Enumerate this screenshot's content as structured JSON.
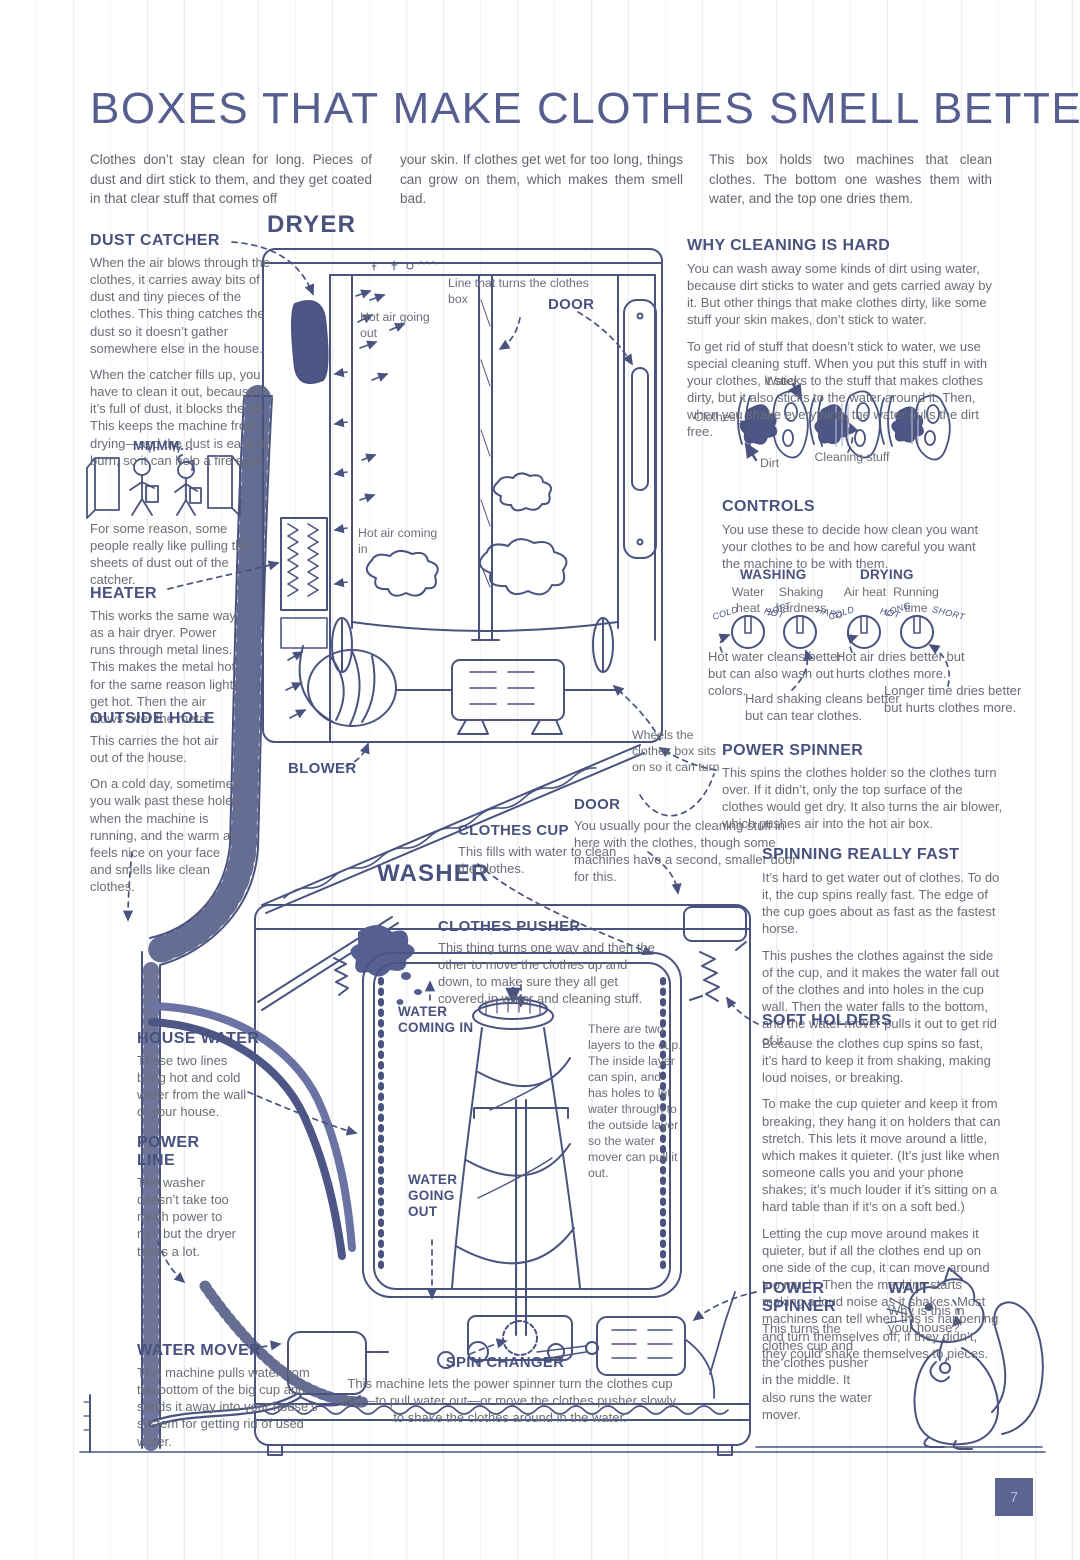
{
  "page": {
    "title": "BOXES THAT MAKE CLOTHES SMELL BETTER",
    "page_number": "7"
  },
  "intro": {
    "col1": "Clothes don’t stay clean for long. Pieces of dust and dirt stick to them, and they get coated in that clear stuff that comes off",
    "col2": "your skin. If clothes get wet for too long, things can grow on them, which makes them smell bad.",
    "col3": "This box holds two machines that clean clothes. The bottom one washes them with water, and the top one dries them."
  },
  "left": {
    "dust_catcher": {
      "title": "DUST CATCHER",
      "p1": "When the air blows through the clothes, it carries away bits of dust and tiny pieces of the clothes. This thing catches the dust so it doesn’t gather somewhere else in the house.",
      "p2": "When the catcher fills up, you have to clean it out, because if it’s full of dust, it blocks the air. This keeps the machine from drying—and the dust is easy to burn, so it can help a fire start.",
      "comic_speech": "MMMM...",
      "comic_caption": "For some reason, some people really like pulling the sheets of dust out of the catcher."
    },
    "heater": {
      "title": "HEATER",
      "p1": "This works the same way as a hair dryer. Power runs through metal lines. This makes the metal hot for the same reason lights get hot. Then the air blows over the metal."
    },
    "outside_hole": {
      "title": "OUTSIDE HOLE",
      "p1": "This carries the hot air out of the house.",
      "p2": "On a cold day, sometimes you walk past these holes when the machine is running, and the warm air feels nice on your face and smells like clean clothes."
    },
    "house_water": {
      "title": "HOUSE WATER",
      "p1": "These two lines bring hot and cold water from the wall of your house."
    },
    "power_line": {
      "title": "POWER LINE",
      "p1": "The washer doesn’t take too much power to run, but the dryer takes a lot."
    },
    "water_mover": {
      "title": "WATER MOVER",
      "p1": "This machine pulls water from the bottom of the big cup and sends it away into your house’s system for getting rid of used water."
    }
  },
  "diagram": {
    "dryer_label": "DRYER",
    "washer_label": "WASHER",
    "line_turns": "Line that turns the clothes box",
    "door_dryer": "DOOR",
    "hot_air_out": "Hot air going out",
    "hot_air_in": "Hot air coming in",
    "blower": "BLOWER",
    "wheels": "Wheels the clothes box sits on so it can turn",
    "door_washer": {
      "title": "DOOR",
      "p1": "You usually pour the cleaning stuff in here with the clothes, though some machines have a second, smaller door for this."
    },
    "clothes_cup": {
      "title": "CLOTHES CUP",
      "p1": "This fills with water to clean the clothes."
    },
    "clothes_pusher": {
      "title": "CLOTHES PUSHER",
      "p1": "This thing turns one way and then the other to move the clothes up and down, to make sure they all get covered in water and cleaning stuff."
    },
    "water_in": "WATER COMING IN",
    "water_out": "WATER GOING OUT",
    "two_layers": "There are two layers to the cup. The inside layer can spin, and has holes to let water through to the outside layer so the water mover can pull it out.",
    "spin_changer": {
      "title": "SPIN CHANGER",
      "p1": "This machine lets the power spinner turn the clothes cup fast—to pull water out—or move the clothes pusher slowly, to shake the clothes around in the water."
    }
  },
  "right": {
    "why_cleaning": {
      "title": "WHY CLEANING IS HARD",
      "p1": "You can wash away some kinds of dirt using water, because dirt sticks to water and gets carried away by it. But other things that make clothes dirty, like some stuff your skin makes, don’t stick to water.",
      "p2": "To get rid of stuff that doesn’t stick to water, we use special cleaning stuff. When you put this stuff in with your clothes, it sticks to the stuff that makes clothes dirty, but it also sticks to the water around it. Then, when you shake everything, the water pulls the dirt free.",
      "labels": {
        "water": "Water",
        "clothes": "Clothes",
        "dirt": "Dirt",
        "cleaning": "Cleaning stuff"
      }
    },
    "controls": {
      "title": "CONTROLS",
      "p1": "You use these to decide how clean you want your clothes to be and how careful you want the machine to be with them.",
      "washing": "WASHING",
      "drying": "DRYING",
      "knob1": "Water heat",
      "knob2": "Shaking hardness",
      "knob3": "Air heat",
      "knob4": "Running time",
      "dials": [
        [
          "COLD",
          "HOT"
        ],
        [
          "SOFT",
          "HARD"
        ],
        [
          "COLD",
          "HOT"
        ],
        [
          "LONG",
          "SHORT"
        ]
      ],
      "c1": "Hot water cleans better but can also wash out colors.",
      "c2": "Hard shaking cleans better but can tear clothes.",
      "c3": "Hot air dries better but hurts clothes more.",
      "c4": "Longer time dries better but hurts clothes more."
    },
    "power_spinner_top": {
      "title": "POWER SPINNER",
      "p1": "This spins the clothes holder so the clothes turn over. If it didn’t, only the top surface of the clothes would get dry. It also turns the air blower, which pushes air into the hot air box."
    },
    "spinning_fast": {
      "title": "SPINNING REALLY FAST",
      "p1": "It’s hard to get water out of clothes. To do it, the cup spins really fast. The edge of the cup goes about as fast as the fastest horse.",
      "p2": "This pushes the clothes against the side of the cup, and it makes the water fall out of the clothes and into holes in the cup wall. Then the water falls to the bottom, and the water mover pulls it out to get rid of it."
    },
    "soft_holders": {
      "title": "SOFT HOLDERS",
      "p1": "Because the clothes cup spins so fast, it’s hard to keep it from shaking, making loud noises, or breaking.",
      "p2": "To make the cup quieter and keep it from breaking, they hang it on holders that can stretch. This lets it move around a little, which makes it quieter. (It’s just like when someone calls you and your phone shakes; it’s much louder if it’s sitting on a hard table than if it’s on a soft bed.)",
      "p3": "Letting the cup move around makes it quieter, but if all the clothes end up on one side of the cup, it can move around too much. Then the machine starts making a loud noise as it shakes. Most machines can tell when this is happening and turn themselves off; if they didn’t, they could shake themselves to pieces."
    },
    "power_spinner_bottom": {
      "title": "POWER SPINNER",
      "p1": "This turns the clothes cup and the clothes pusher in the middle. It also runs the water mover."
    },
    "wait": {
      "title": "WAIT",
      "p1": "Why is this in your house?"
    }
  }
}
